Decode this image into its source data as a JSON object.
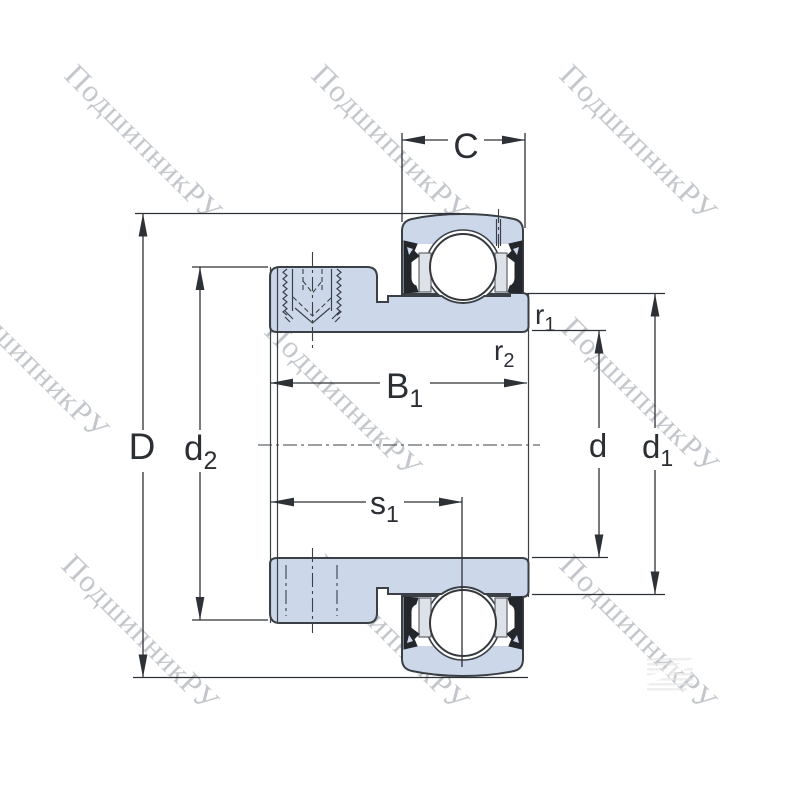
{
  "watermark": {
    "text": "ПодшипникРУ",
    "color": "#99a0a8"
  },
  "drawing": {
    "title": "insert-bearing-cross-section",
    "fill_color": "#ccd8ea",
    "outline_color": "#3b4046",
    "labels": {
      "C": {
        "main": "C",
        "sub": ""
      },
      "D": {
        "main": "D",
        "sub": ""
      },
      "d2": {
        "main": "d",
        "sub": "2"
      },
      "B1": {
        "main": "B",
        "sub": "1"
      },
      "s1": {
        "main": "s",
        "sub": "1"
      },
      "r1": {
        "main": "r",
        "sub": "1"
      },
      "r2": {
        "main": "r",
        "sub": "2"
      },
      "d": {
        "main": "d",
        "sub": ""
      },
      "d1": {
        "main": "d",
        "sub": "1"
      }
    }
  }
}
